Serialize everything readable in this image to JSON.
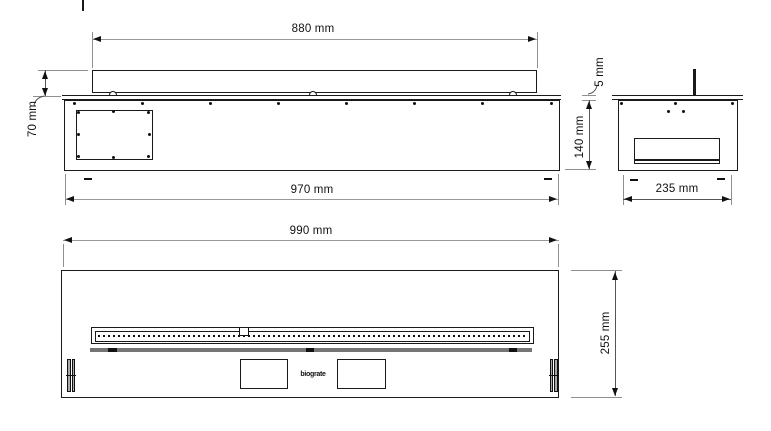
{
  "drawing": {
    "type": "technical-dimension-drawing",
    "views": {
      "side": {
        "dim_insert_width": "880 mm",
        "dim_insert_height": "70 mm",
        "dim_housing_width": "970 mm"
      },
      "end": {
        "dim_plate_thickness": "5 mm",
        "dim_housing_height": "140 mm",
        "dim_housing_depth": "235 mm"
      },
      "plan": {
        "dim_overall_length": "990 mm",
        "dim_overall_depth": "255 mm",
        "logo_text": "biograte"
      }
    },
    "colors": {
      "outline": "#1a1a1a",
      "dimension_line": "#999999",
      "extension_line": "#555555",
      "text": "#111111",
      "background": "#ffffff"
    }
  }
}
